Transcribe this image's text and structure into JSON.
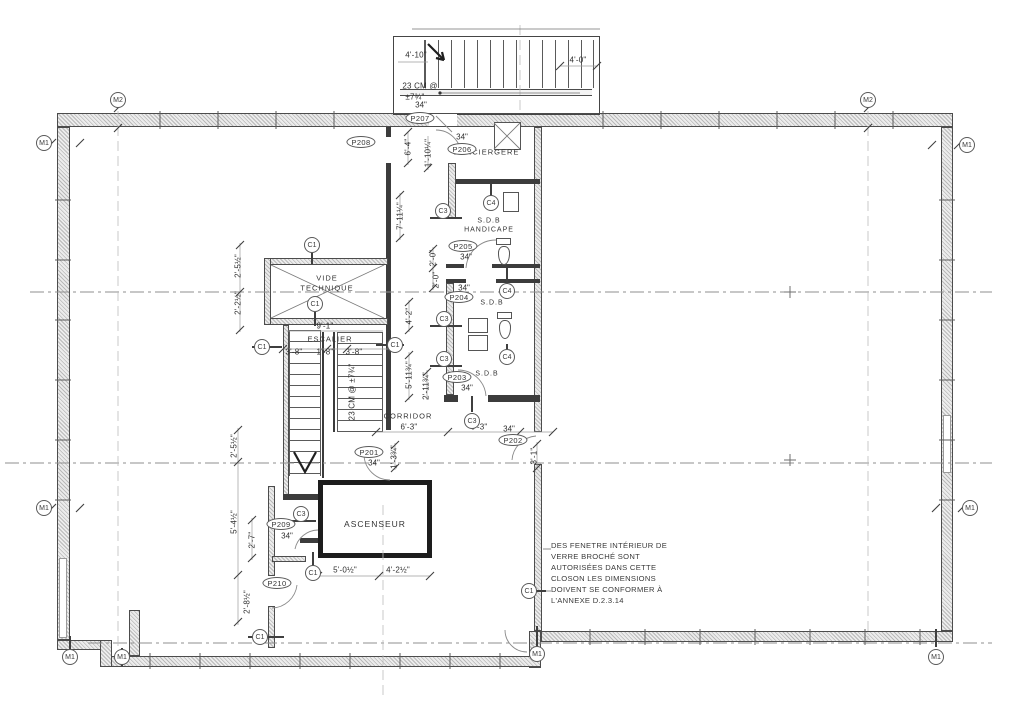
{
  "tags": {
    "m1": "M1",
    "m2": "M2",
    "c1": "C1",
    "c3": "C3",
    "c4": "C4"
  },
  "door_tags": {
    "p201": "P201",
    "p202": "P202",
    "p203": "P203",
    "p204": "P204",
    "p205": "P205",
    "p206": "P206",
    "p207": "P207",
    "p208": "P208",
    "p209": "P209",
    "p210": "P210"
  },
  "door_width": "34\"",
  "rooms": {
    "vide_line1": "VIDE",
    "vide_line2": "TECHNIQUE",
    "escalier": "ESCALIER",
    "corridor": "CORRIDOR",
    "ascenseur": "ASCENSEUR",
    "conciergerie": "CONCIERGERE",
    "sdb": "S.D.B",
    "handicape": "HANDICAPE"
  },
  "dimensions": {
    "d4_10": "4'-10\"",
    "d4_0": "4'-0\"",
    "riser_note_l1": "23 CM @",
    "riser_note_l2": "±7¾\"",
    "riser_note_stair": "23 CM @ ±7¾\"",
    "d6_4": "6'-4\"",
    "d1_10q": "1'-10¼\"",
    "d7_11q": "7'-11¼\"",
    "d2_0": "2'-0\"",
    "d4_2": "4'-2\"",
    "d5_11t": "5'-11¾\"",
    "d2_11t": "2'-11¾\"",
    "d6_3": "6'-3\"",
    "d3_1": "3'-1\"",
    "d1_3t": "1'-3¾\"",
    "d2_5h": "2'-5½\"",
    "d2_2h": "2'-2½\"",
    "d9_1": "9'-1\"",
    "d3_8": "3'-8\"",
    "d1_8": "1'-8\"",
    "d5_4h": "5'-4½\"",
    "d2_7": "2'-7\"",
    "d2_8h": "2'-8½\"",
    "d5_0h": "5'-0½\"",
    "d4_2h": "4'-2½\""
  },
  "note": {
    "l1": "DES FENETRE INTÉRIEUR DE",
    "l2": "VERRE BROCHÉ SONT",
    "l3": "AUTORISÉES DANS CETTE",
    "l4": "CLOSON LES DIMENSIONS",
    "l5": "DOIVENT SE CONFORMER À",
    "l6": "L'ANNEXE D.2.3.14"
  },
  "colors": {
    "line": "#3c3c3c",
    "wall_hatch": "#bfbfbf",
    "background": "#ffffff"
  }
}
